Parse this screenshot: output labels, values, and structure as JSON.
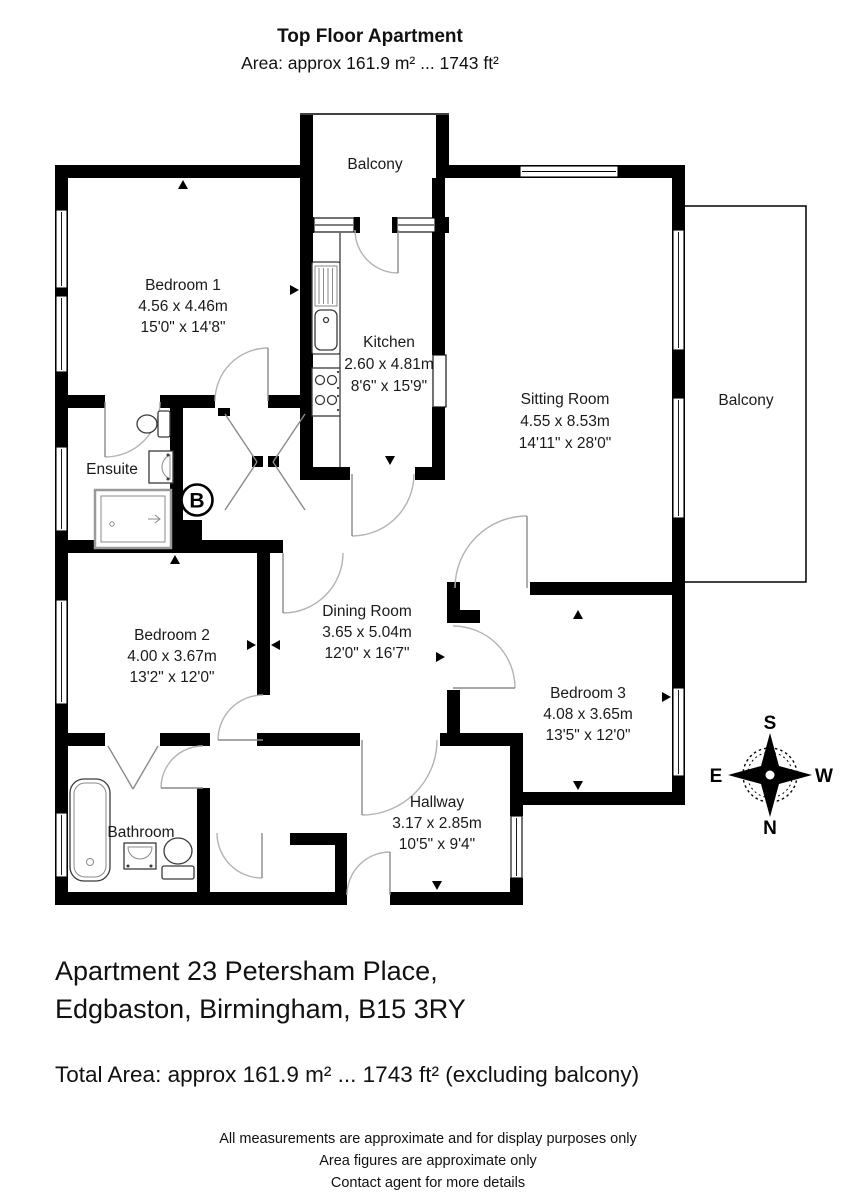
{
  "header": {
    "title": "Top Floor Apartment",
    "subtitle": "Area: approx 161.9 m² ... 1743 ft²"
  },
  "plan": {
    "rooms": {
      "bedroom1": {
        "name": "Bedroom 1",
        "metric": "4.56 x 4.46m",
        "imperial": "15'0\" x 14'8\""
      },
      "kitchen": {
        "name": "Kitchen",
        "metric": "2.60 x 4.81m",
        "imperial": "8'6\" x 15'9\""
      },
      "sitting_room": {
        "name": "Sitting Room",
        "metric": "4.55 x 8.53m",
        "imperial": "14'11\" x 28'0\""
      },
      "balcony_top": {
        "name": "Balcony"
      },
      "balcony_right": {
        "name": "Balcony"
      },
      "ensuite": {
        "name": "Ensuite"
      },
      "bedroom2": {
        "name": "Bedroom 2",
        "metric": "4.00 x 3.67m",
        "imperial": "13'2\" x 12'0\""
      },
      "dining_room": {
        "name": "Dining Room",
        "metric": "3.65 x 5.04m",
        "imperial": "12'0\" x 16'7\""
      },
      "bedroom3": {
        "name": "Bedroom 3",
        "metric": "4.08 x 3.65m",
        "imperial": "13'5\" x 12'0\""
      },
      "bathroom": {
        "name": "Bathroom"
      },
      "hallway": {
        "name": "Hallway",
        "metric": "3.17 x 2.85m",
        "imperial": "10'5\" x 9'4\""
      }
    },
    "boiler_label": "B",
    "compass": {
      "north": "N",
      "south": "S",
      "east": "E",
      "west": "W"
    }
  },
  "colors": {
    "wall": "#000000",
    "door_arc": "#b3b3b3",
    "background": "#ffffff",
    "text": "#1a1a1a"
  },
  "footer": {
    "address_line1": "Apartment 23 Petersham Place,",
    "address_line2": "Edgbaston, Birmingham, B15 3RY",
    "total_area": "Total Area: approx 161.9 m² ... 1743 ft² (excluding balcony)",
    "disclaimer1": "All measurements are approximate and for display purposes only",
    "disclaimer2": "Area figures are approximate only",
    "disclaimer3": "Contact agent for more details"
  }
}
